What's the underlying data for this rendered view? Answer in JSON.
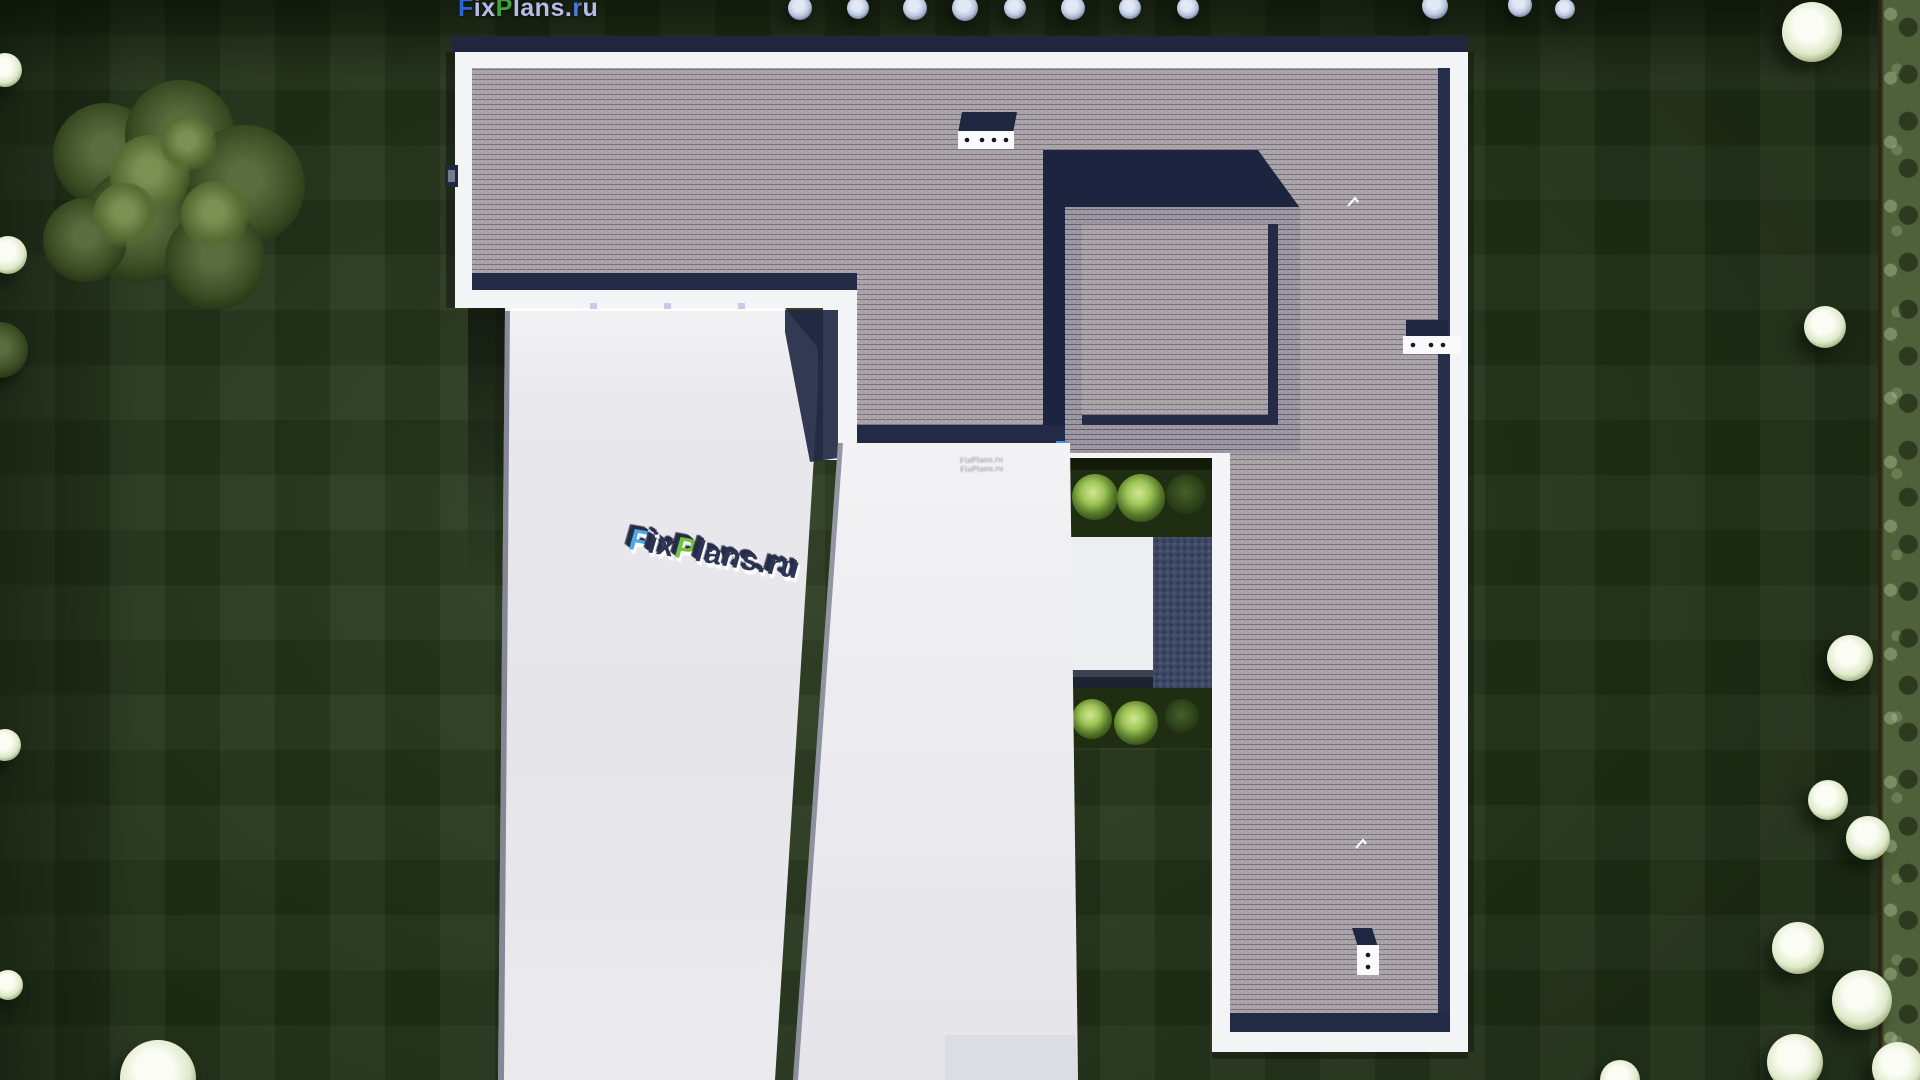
{
  "site": {
    "logo": {
      "text": "FixPlans.ru",
      "segments": [
        {
          "text": "F",
          "color": "#2f63d8"
        },
        {
          "text": "ix",
          "color": "#b7bbe6"
        },
        {
          "text": "P",
          "color": "#3ea43c"
        },
        {
          "text": "lans",
          "color": "#b7bbe6"
        },
        {
          "text": ".",
          "color": "#b7bbe6"
        },
        {
          "text": "r",
          "color": "#4a7ae0"
        },
        {
          "text": "u",
          "color": "#b7bbe6"
        }
      ]
    },
    "center_watermark": {
      "text": "FixPlans.ru",
      "segments": [
        {
          "text": "F",
          "color": "#4fa6e4"
        },
        {
          "text": "ix",
          "color": "#2e3554"
        },
        {
          "text": "P",
          "color": "#72c33e"
        },
        {
          "text": "lans",
          "color": "#2e3554"
        },
        {
          "text": ".ru",
          "color": "#2e3554"
        }
      ]
    },
    "small_watermark": {
      "line1": "FixPlans.ru",
      "line2": "FixPlans.ru"
    }
  },
  "scene": {
    "type": "aerial-roof-render",
    "roof_vents": [
      {
        "location": "top-band",
        "dots": 4
      },
      {
        "location": "right-wing-upper",
        "dots": 3
      },
      {
        "location": "right-wing-lower",
        "dots": 2
      }
    ],
    "palette": {
      "lawn": "#24331c",
      "roof_tile": "#a8a2a7",
      "roof_tile_dark": "#9d97a2",
      "parapet_white": "#f3f4f6",
      "shadow_navy": "#232a45",
      "flat_roof": "#e8e8ec",
      "patio": "#edeef1",
      "hedge_blue": "#3d4965",
      "bush_green": "#9dc457",
      "garden_green": "#1f2d12",
      "boundary_hedge": "#4f613a",
      "tree_periwinkle": "#b9c4de",
      "tree_white_green": "#dfe9c9",
      "blue_item": "#4d8fd6"
    }
  }
}
